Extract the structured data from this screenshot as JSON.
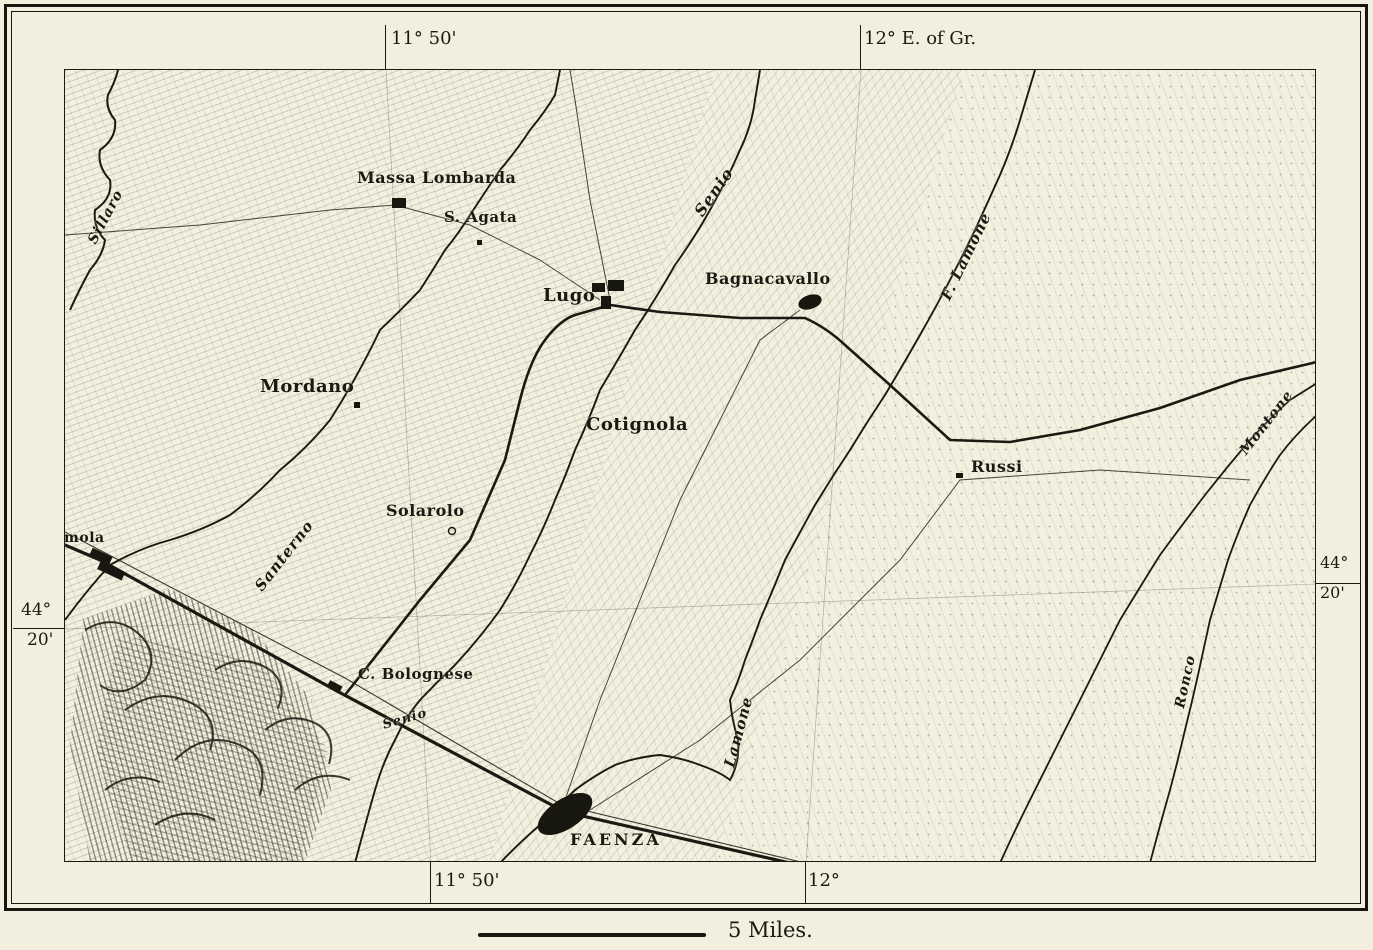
{
  "palette": {
    "paper": "#f2efde",
    "ink": "#1b1a12"
  },
  "margins": {
    "top_left_longitude": "11° 50'",
    "top_right_longitude": "12° E. of Gr.",
    "bottom_left_longitude": "11° 50'",
    "bottom_right_longitude": "12°",
    "left_latitude_degrees": "44°",
    "left_latitude_minutes": "20'",
    "right_latitude_degrees": "44°",
    "right_latitude_minutes": "20'"
  },
  "scale": {
    "label": "5 Miles."
  },
  "map": {
    "towns": [
      {
        "name": "Massa Lombarda"
      },
      {
        "name": "S. Agata"
      },
      {
        "name": "Lugo"
      },
      {
        "name": "Bagnacavallo"
      },
      {
        "name": "Mordano"
      },
      {
        "name": "Cotignola"
      },
      {
        "name": "Solarolo"
      },
      {
        "name": "Russi"
      },
      {
        "name": "C. Bolognese"
      },
      {
        "name": "FAENZA"
      },
      {
        "name": "Imola"
      }
    ],
    "rivers": [
      {
        "name": "Sillaro"
      },
      {
        "name": "Senio"
      },
      {
        "name": "Santerno"
      },
      {
        "name": "Senio"
      },
      {
        "name": "Lamone"
      },
      {
        "name": "F. Lamone"
      },
      {
        "name": "Montone"
      },
      {
        "name": "Ronco"
      }
    ]
  }
}
